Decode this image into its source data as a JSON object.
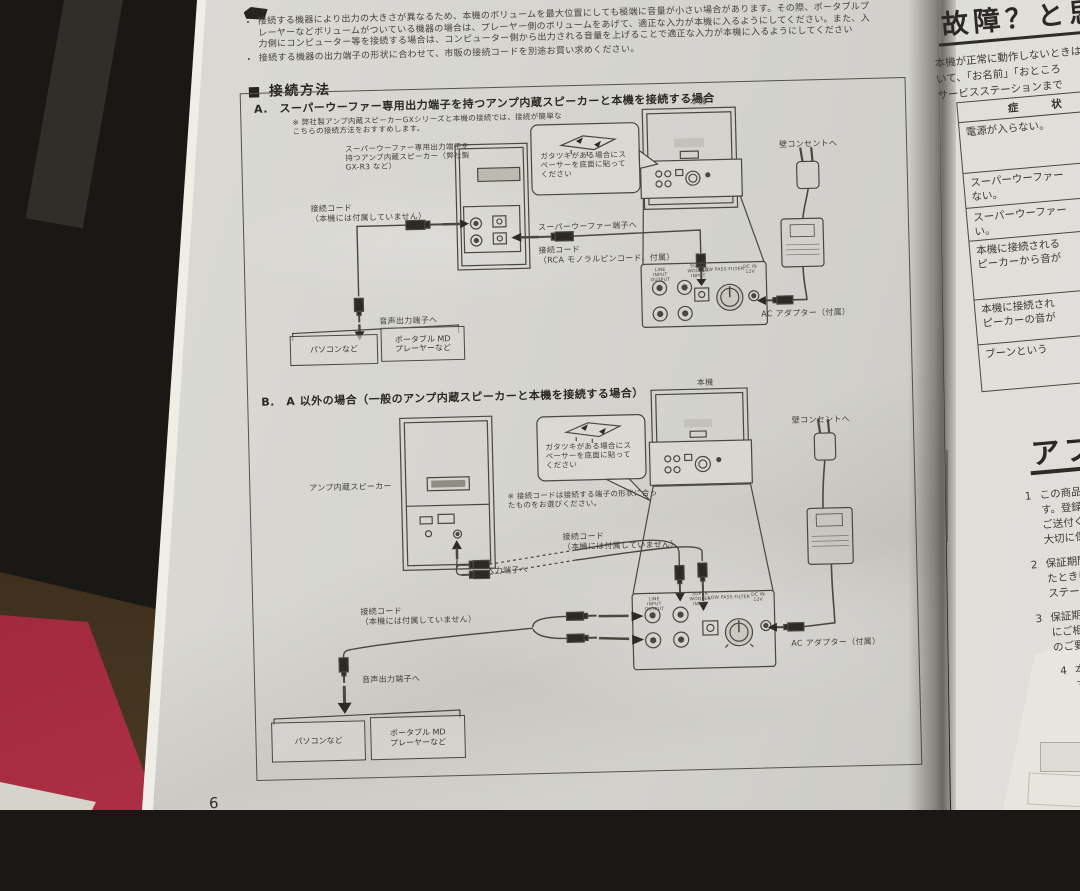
{
  "page_number": "6",
  "intro": {
    "bullets": [
      "接続する機器により出力の大きさが異なるため、本機のボリュームを最大位置にしても極端に音量が小さい場合があります。その際、ポータブルプレーヤーなどボリュームがついている機器の場合は、プレーヤー側のボリュームをあげて、適正な入力が本機に入るようにしてください。また、入力側にコンピューター等を接続する場合は、コンピューター側から出力される音量を上げることで適正な入力が本機に入るようにしてください",
      "接続する機器の出力端子の形状に合わせて、市販の接続コードを別途お買い求めください。"
    ]
  },
  "section": {
    "title": "■ 接続方法"
  },
  "diagram_a": {
    "title": "A.　スーパーウーファー専用出力端子を持つアンプ内蔵スピーカーと本機を接続する場合",
    "note": "※ 弊社製アンプ内蔵スピーカーGXシリーズと本機の接続では、接続が簡単なこちらの接続方法をおすすめします。",
    "speaker_label": "スーパーウーファー専用出力端子を持つアンプ内蔵スピーカー（弊社製 GX-R3 など）",
    "main_unit": "本機",
    "cord_not_included": "接続コード\n（本機には付属していません）",
    "to_sw_terminal": "スーパーウーファー端子へ",
    "rca_cord": "接続コード\n（RCA モノラルピンコード、付属）",
    "to_audio_out": "音声出力端子へ",
    "spacer_note": "ガタツキがある場合にスペーサーを底面に貼ってください",
    "to_wall_outlet": "壁コンセントへ",
    "ac_adapter": "AC アダプター（付属）",
    "pc_box": "パソコンなど",
    "md_box": "ポータブル MD\nプレーヤーなど"
  },
  "diagram_b": {
    "title": "B.　A 以外の場合（一般のアンプ内蔵スピーカーと本機を接続する場合）",
    "speaker_label": "アンプ内蔵スピーカー",
    "main_unit": "本機",
    "spacer_note": "ガタツキがある場合にスペーサーを底面に貼ってください",
    "cord_shape_note": "※ 接続コードは接続する端子の形状に合ったものをお選びください。",
    "cord_not_included": "接続コード\n（本機には付属していません）",
    "to_input_terminal": "入力端子へ",
    "cord_not_included2": "接続コード\n（本機には付属していません）",
    "to_audio_out": "音声出力端子へ",
    "to_wall_outlet": "壁コンセントへ",
    "ac_adapter": "AC アダプター（付属）",
    "pc_box": "パソコンなど",
    "md_box": "ポータブル MD\nプレーヤーなど"
  },
  "panel": {
    "line_block": "LINE\nINPUT OUTPUT",
    "sw_block": "SUPER WOOFER\nINPUT",
    "lpf": "LOW PASS FILTER",
    "dc": "DC IN\n12V"
  },
  "right_page": {
    "header": "故障？と思",
    "intro_lines": "本機が正常に動作しないときは\nいて、「お名前」「おところ\nサービスステーションまで",
    "table": {
      "header": "症　　状",
      "rows": [
        "電源が入らない。",
        "スーパーウーファー\nない。",
        "スーパーウーファー\nい。",
        "本機に接続される\nピーカーから音が",
        "本機に接続され\nピーカーの音が",
        "ブーンという"
      ]
    },
    "after_header": "アフタ",
    "items": [
      {
        "num": "1",
        "text": "この商品に\nす。登録\nご送付くだ\n大切に保"
      },
      {
        "num": "2",
        "text": "保証期間\nたときは\nステーシ"
      },
      {
        "num": "3",
        "text": "保証期間\nにご相談\nのご要望"
      },
      {
        "num": "4",
        "text": "本機の\nす。性"
      }
    ]
  }
}
